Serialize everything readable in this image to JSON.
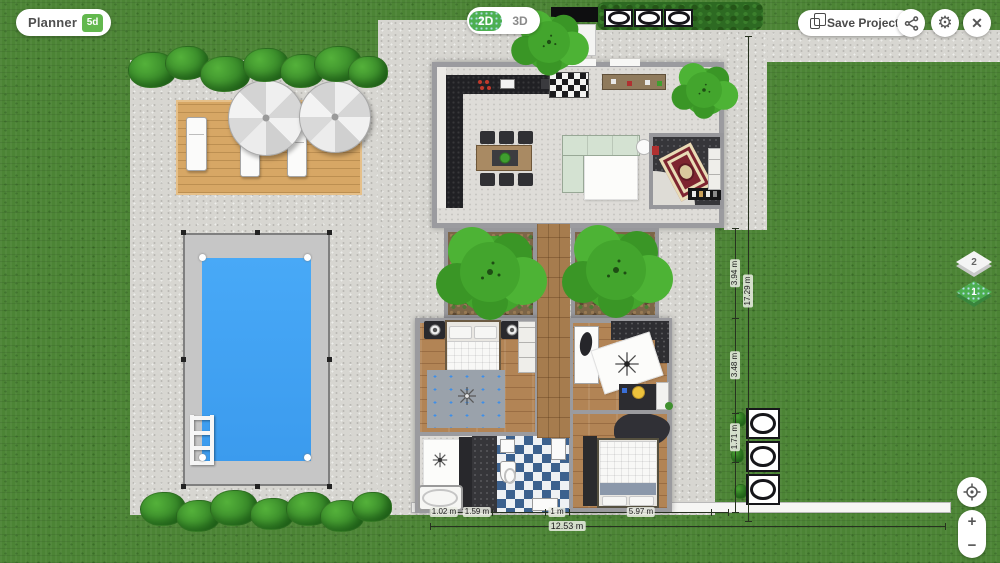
{
  "app": {
    "name": "Planner",
    "badge": "5d"
  },
  "toolbar": {
    "view_toggle": {
      "option_2d": "2D",
      "option_3d": "3D",
      "selected": "2D"
    },
    "save_button": {
      "label": "Save Project",
      "icon": "copy-icon"
    },
    "share_button": {
      "icon": "share-nodes-icon"
    },
    "settings_button": {
      "icon": "gear-icon",
      "glyph": "⚙"
    },
    "close_button": {
      "icon": "close-icon",
      "glyph": "✕"
    }
  },
  "floor_selector": {
    "floors": [
      {
        "label": "2",
        "active": false
      },
      {
        "label": "1",
        "active": true
      }
    ]
  },
  "map_controls": {
    "locate_icon": "crosshair-icon",
    "zoom_in": "+",
    "zoom_out": "−"
  },
  "dimensions": {
    "right": {
      "total": "17.29 m",
      "segments": [
        "3.94 m",
        "3.48 m",
        "1.71 m"
      ]
    },
    "bottom": {
      "total": "12.53 m",
      "segments": [
        "1.02 m",
        "1.59 m",
        "1 m",
        "5.97 m"
      ]
    }
  },
  "colors": {
    "brand_green": "#63b84e",
    "toggle_green": "#4caf50",
    "pool_water": "#3fa2f5",
    "grass": "#4c8435",
    "paving": "#d7d6d1",
    "deck": "#d7a765",
    "tree": "#43a52d"
  }
}
